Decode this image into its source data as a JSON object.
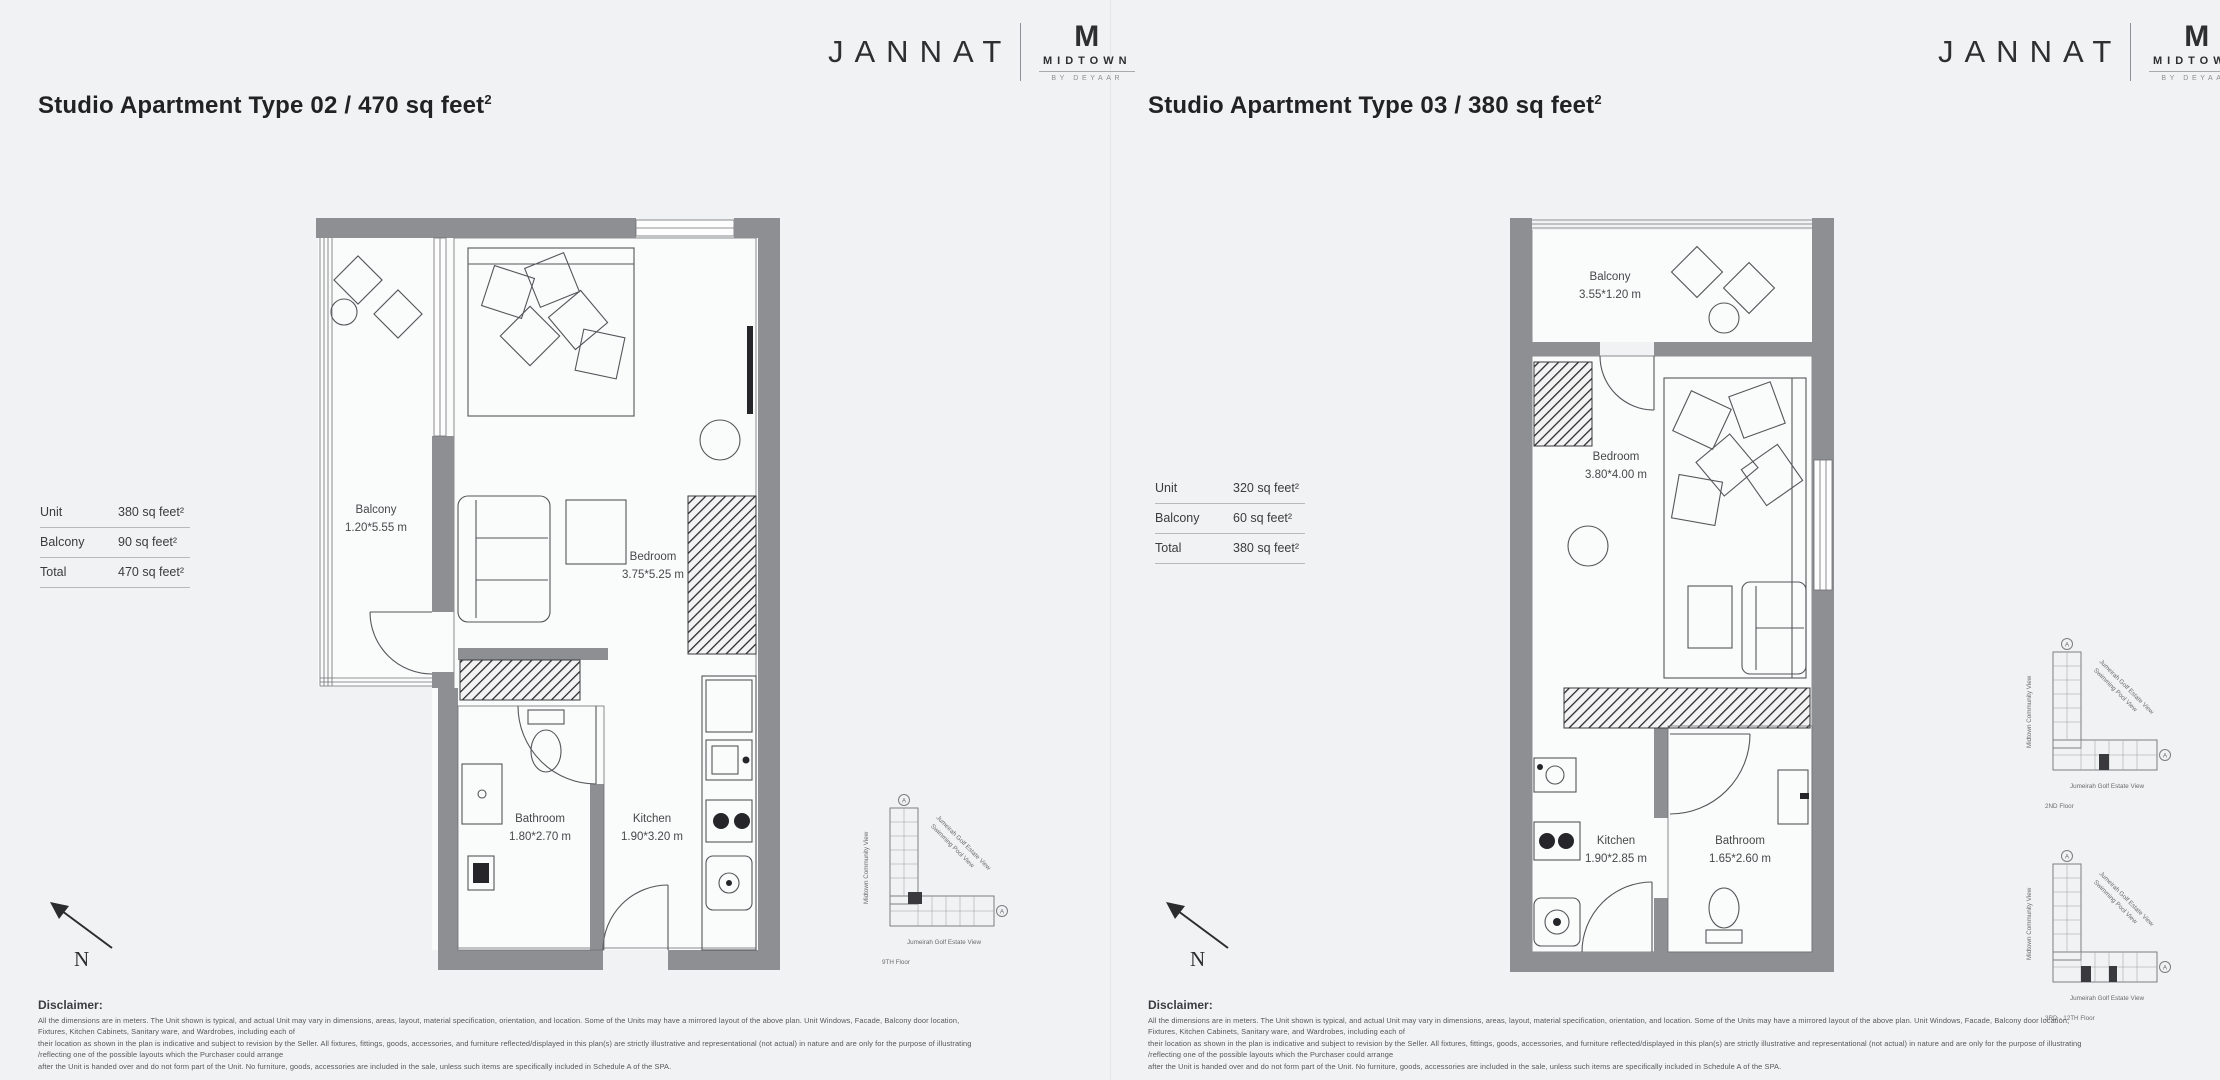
{
  "colors": {
    "background": "#f1f2f3",
    "wall_gray": "#8d8f92",
    "line_gray": "#55565a",
    "text_dark": "#222225"
  },
  "brand": {
    "name": "JANNAT",
    "monogram": "M",
    "midtown": "MIDTOWN",
    "byline": "BY DEYAAR"
  },
  "north_label": "N",
  "keyplan_labels": {
    "left_view": "Midtown Community View",
    "diag_view_1": "Jumeirah Golf Estate View",
    "diag_view_2": "Swimming Pool View",
    "bottom_view": "Jumeirah Golf Estate View",
    "badge": "A"
  },
  "panels": [
    {
      "title": "Studio Apartment Type 02 / 470 sq feet",
      "title_sup": "2",
      "stats": [
        {
          "label": "Unit",
          "value": "380 sq feet²"
        },
        {
          "label": "Balcony",
          "value": "90 sq feet²"
        },
        {
          "label": "Total",
          "value": "470 sq feet²"
        }
      ],
      "rooms": {
        "bedroom": {
          "name": "Bedroom",
          "dims": "3.75*5.25 m"
        },
        "balcony": {
          "name": "Balcony",
          "dims": "1.20*5.55 m"
        },
        "bathroom": {
          "name": "Bathroom",
          "dims": "1.80*2.70 m"
        },
        "kitchen": {
          "name": "Kitchen",
          "dims": "1.90*3.20 m"
        }
      },
      "keyplans": [
        {
          "floor": "9TH Floor"
        }
      ]
    },
    {
      "title": "Studio Apartment Type 03 / 380 sq feet",
      "title_sup": "2",
      "stats": [
        {
          "label": "Unit",
          "value": "320 sq feet²"
        },
        {
          "label": "Balcony",
          "value": "60 sq feet²"
        },
        {
          "label": "Total",
          "value": "380 sq feet²"
        }
      ],
      "rooms": {
        "balcony": {
          "name": "Balcony",
          "dims": "3.55*1.20 m"
        },
        "bedroom": {
          "name": "Bedroom",
          "dims": "3.80*4.00 m"
        },
        "kitchen": {
          "name": "Kitchen",
          "dims": "1.90*2.85 m"
        },
        "bathroom": {
          "name": "Bathroom",
          "dims": "1.65*2.60 m"
        }
      },
      "keyplans": [
        {
          "floor": "2ND Floor"
        },
        {
          "floor": "3RD - 12TH Floor"
        }
      ]
    }
  ],
  "disclaimer": {
    "heading": "Disclaimer:",
    "lines": [
      "All the dimensions are in meters. The Unit shown is typical, and actual Unit may vary in dimensions, areas, layout, material specification, orientation, and location. Some of the Units may have a mirrored layout of the above plan. Unit Windows, Facade, Balcony door location, Fixtures, Kitchen Cabinets, Sanitary ware, and Wardrobes, including each of",
      "their location as shown in the plan is indicative and subject to revision by the Seller. All fixtures, fittings, goods, accessories, and furniture reflected/displayed in this plan(s) are strictly illustrative and representational (not actual) in nature and are only for the purpose of illustrating /reflecting one of the possible layouts which the Purchaser could arrange",
      "after the Unit is handed over and do not form part of the Unit. No furniture, goods, accessories are included in the sale, unless such items are specifically included in Schedule A of the SPA."
    ]
  }
}
